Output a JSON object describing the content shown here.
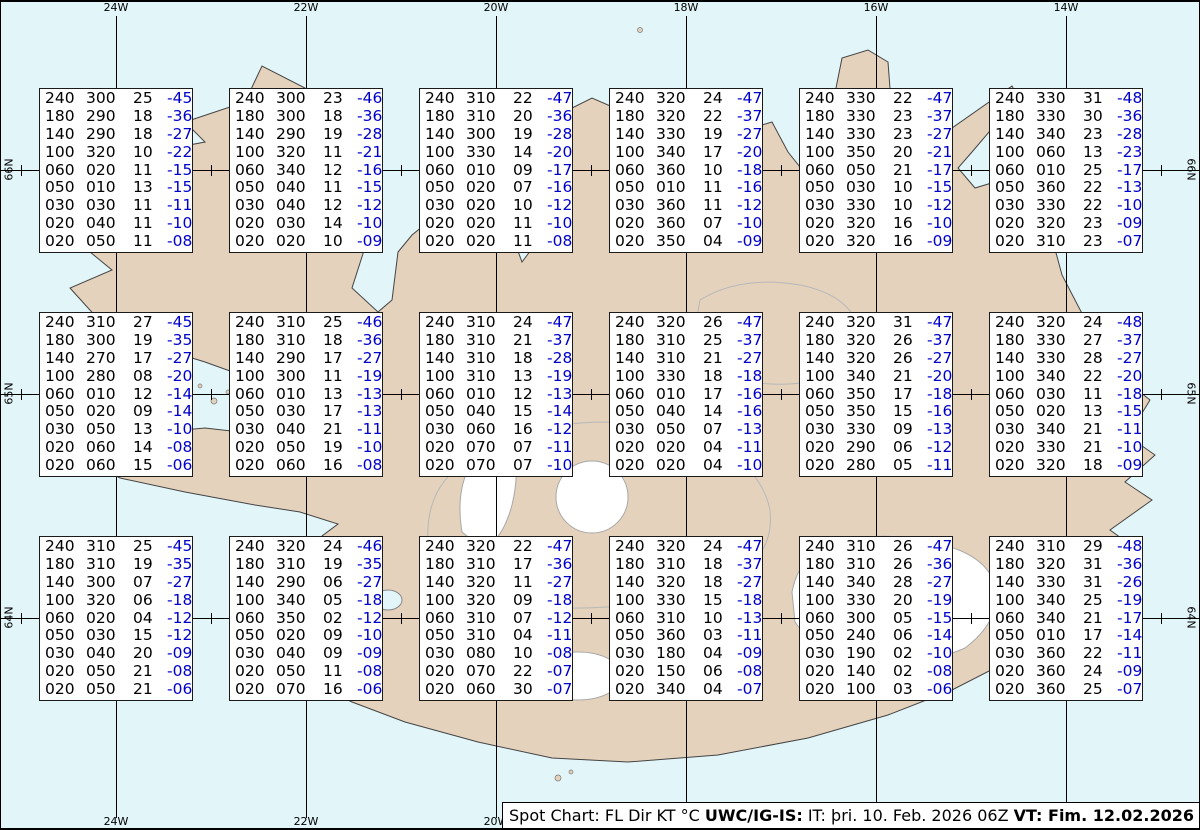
{
  "map": {
    "lon_labels": [
      "24W",
      "22W",
      "20W",
      "18W",
      "16W",
      "14W"
    ],
    "lat_labels": [
      "66N",
      "65N",
      "64N"
    ]
  },
  "status_bar": {
    "prefix": "Spot Chart: FL Dir KT °C ",
    "source": "UWC/IG-IS:",
    "issue": " IT: þri. 10. Feb. 2026 06Z ",
    "valid": "VT: Fim. 12.02.2026 11Z",
    "suffix": " (+53 h)"
  },
  "colors": {
    "water": "#e2f5f9",
    "land": "#e4d2bd",
    "glacier": "#ffffff",
    "temperature_blue": "#0000cd",
    "box_background": "#ffffff",
    "grid_line": "#000000"
  },
  "spot_boxes": [
    {
      "row": 0,
      "col": 0,
      "rows": [
        "240 300 25 -45",
        "180 290 18 -36",
        "140 290 18 -27",
        "100 320 10 -22",
        "060 020 11 -15",
        "050 010 13 -15",
        "030 030 11 -11",
        "020 040 11 -10",
        "020 050 11 -08"
      ]
    },
    {
      "row": 0,
      "col": 1,
      "rows": [
        "240 300 23 -46",
        "180 300 18 -36",
        "140 290 19 -28",
        "100 320 11 -21",
        "060 340 12 -16",
        "050 040 11 -15",
        "030 040 12 -12",
        "020 030 14 -10",
        "020 020 10 -09"
      ]
    },
    {
      "row": 0,
      "col": 2,
      "rows": [
        "240 310 22 -47",
        "180 310 20 -36",
        "140 300 19 -28",
        "100 330 14 -20",
        "060 010 09 -17",
        "050 020 07 -16",
        "030 020 10 -12",
        "020 020 11 -10",
        "020 020 11 -08"
      ]
    },
    {
      "row": 0,
      "col": 3,
      "rows": [
        "240 320 24 -47",
        "180 320 22 -37",
        "140 330 19 -27",
        "100 340 17 -20",
        "060 360 10 -18",
        "050 010 11 -16",
        "030 360 11 -12",
        "020 360 07 -10",
        "020 350 04 -09"
      ]
    },
    {
      "row": 0,
      "col": 4,
      "rows": [
        "240 330 22 -47",
        "180 330 23 -37",
        "140 330 23 -27",
        "100 350 20 -21",
        "060 050 21 -17",
        "050 030 10 -15",
        "030 330 10 -12",
        "020 320 16 -10",
        "020 320 16 -09"
      ]
    },
    {
      "row": 0,
      "col": 5,
      "rows": [
        "240 330 31 -48",
        "180 330 30 -36",
        "140 340 23 -28",
        "100 060 13 -23",
        "060 010 25 -17",
        "050 360 22 -13",
        "030 330 22 -10",
        "020 320 23 -09",
        "020 310 23 -07"
      ]
    },
    {
      "row": 1,
      "col": 0,
      "rows": [
        "240 310 27 -45",
        "180 300 19 -35",
        "140 270 17 -27",
        "100 280 08 -20",
        "060 010 12 -14",
        "050 020 09 -14",
        "030 050 13 -10",
        "020 060 14 -08",
        "020 060 15 -06"
      ]
    },
    {
      "row": 1,
      "col": 1,
      "rows": [
        "240 310 25 -46",
        "180 310 18 -36",
        "140 290 17 -27",
        "100 300 11 -19",
        "060 010 13 -13",
        "050 030 17 -13",
        "030 040 21 -11",
        "020 050 19 -10",
        "020 060 16 -08"
      ]
    },
    {
      "row": 1,
      "col": 2,
      "rows": [
        "240 310 24 -47",
        "180 310 21 -37",
        "140 310 18 -28",
        "100 310 13 -19",
        "060 010 12 -13",
        "050 040 15 -14",
        "030 060 16 -12",
        "020 070 07 -11",
        "020 070 07 -10"
      ]
    },
    {
      "row": 1,
      "col": 3,
      "rows": [
        "240 320 26 -47",
        "180 310 25 -37",
        "140 310 21 -27",
        "100 330 18 -18",
        "060 010 17 -16",
        "050 040 14 -16",
        "030 050 07 -13",
        "020 020 04 -11",
        "020 020 04 -10"
      ]
    },
    {
      "row": 1,
      "col": 4,
      "rows": [
        "240 320 31 -47",
        "180 320 26 -37",
        "140 320 26 -27",
        "100 340 21 -20",
        "060 350 17 -18",
        "050 350 15 -16",
        "030 330 09 -13",
        "020 290 06 -12",
        "020 280 05 -11"
      ]
    },
    {
      "row": 1,
      "col": 5,
      "rows": [
        "240 320 24 -48",
        "180 330 27 -37",
        "140 330 28 -27",
        "100 340 22 -20",
        "060 030 11 -18",
        "050 020 13 -15",
        "030 340 21 -11",
        "020 330 21 -10",
        "020 320 18 -09"
      ]
    },
    {
      "row": 2,
      "col": 0,
      "rows": [
        "240 310 25 -45",
        "180 310 19 -35",
        "140 300 07 -27",
        "100 320 06 -18",
        "060 020 04 -12",
        "050 030 15 -12",
        "030 040 20 -09",
        "020 050 21 -08",
        "020 050 21 -06"
      ]
    },
    {
      "row": 2,
      "col": 1,
      "rows": [
        "240 320 24 -46",
        "180 310 19 -35",
        "140 290 06 -27",
        "100 340 05 -18",
        "060 350 02 -12",
        "050 020 09 -10",
        "030 040 09 -09",
        "020 050 11 -08",
        "020 070 16 -06"
      ]
    },
    {
      "row": 2,
      "col": 2,
      "rows": [
        "240 320 22 -47",
        "180 310 17 -36",
        "140 320 11 -27",
        "100 320 09 -18",
        "060 310 07 -12",
        "050 310 04 -11",
        "030 080 10 -08",
        "020 070 22 -07",
        "020 060 30 -07"
      ]
    },
    {
      "row": 2,
      "col": 3,
      "rows": [
        "240 320 24 -47",
        "180 310 18 -37",
        "140 320 18 -27",
        "100 330 15 -18",
        "060 310 10 -13",
        "050 360 03 -11",
        "030 180 04 -09",
        "020 150 06 -08",
        "020 340 04 -07"
      ]
    },
    {
      "row": 2,
      "col": 4,
      "rows": [
        "240 310 26 -47",
        "180 310 26 -36",
        "140 340 28 -27",
        "100 330 20 -19",
        "060 300 05 -15",
        "050 240 06 -14",
        "030 190 02 -10",
        "020 140 02 -08",
        "020 100 03 -06"
      ]
    },
    {
      "row": 2,
      "col": 5,
      "rows": [
        "240 310 29 -48",
        "180 320 31 -36",
        "140 330 31 -26",
        "100 340 25 -19",
        "060 340 21 -17",
        "050 010 17 -14",
        "030 360 22 -11",
        "020 360 24 -09",
        "020 360 25 -07"
      ]
    }
  ]
}
